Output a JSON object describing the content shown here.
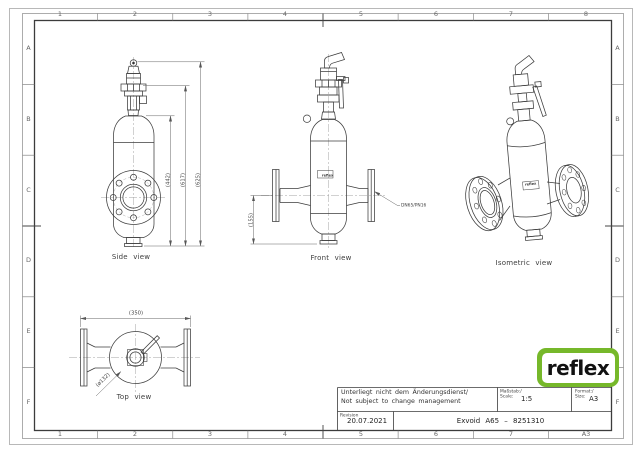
{
  "brand": {
    "logo_text": "reflex",
    "logo_green": "#76b82a"
  },
  "grid": {
    "cols_top": [
      "1",
      "2",
      "3",
      "4",
      "5",
      "6",
      "7",
      "8"
    ],
    "cols_bottom": [
      "1",
      "2",
      "3",
      "4",
      "5",
      "6",
      "7",
      "A3"
    ],
    "rows_left": [
      "A",
      "B",
      "C",
      "D",
      "E",
      "F"
    ],
    "rows_right": [
      "A",
      "B",
      "C",
      "D",
      "E",
      "F"
    ]
  },
  "views": {
    "side": {
      "caption": "Side view",
      "dims": [
        "(442)",
        "(617)",
        "(625)"
      ]
    },
    "front": {
      "caption": "Front view",
      "dim": "(155)",
      "flange_label": "DN65/PN16",
      "body_label": "reflex"
    },
    "iso": {
      "caption": "Isometric view",
      "body_label": "reflex"
    },
    "top": {
      "caption": "Top view",
      "dim_width": "(350)",
      "dim_dia": "(ø132)"
    }
  },
  "title_block": {
    "note_line1": "Unterliegt nicht dem Änderungsdienst/",
    "note_line2": "Not subject to change management",
    "scale_label_de": "Maßstab:/",
    "scale_label_en": "Scale:",
    "scale_value": "1:5",
    "format_label_de": "Format:/",
    "format_label_en": "Size:",
    "format_value": "A3",
    "revision_label": "Revision",
    "revision_value": "20.07.2021",
    "drawing_title": "Exvoid A65 – 8251310"
  }
}
